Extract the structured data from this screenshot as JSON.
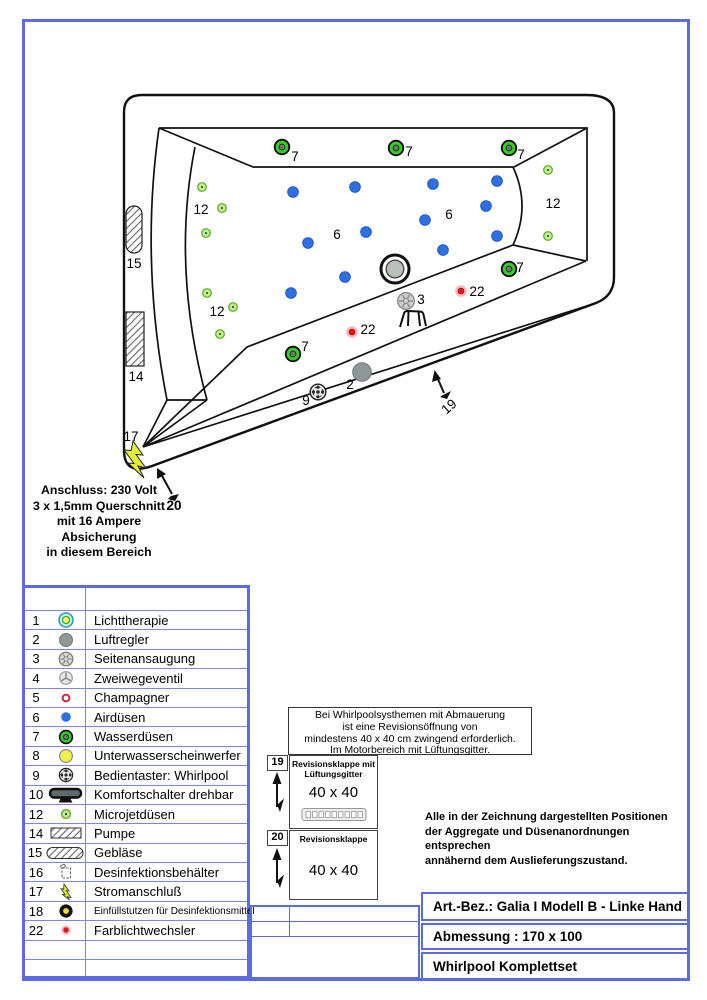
{
  "frame_color": "#5e6ae0",
  "diagram": {
    "colors": {
      "water": "#38cb2b",
      "air": "#2e6fe2",
      "micro": "#bdf08e",
      "micro_edge": "#55aa22",
      "color_light": "#e31515",
      "color_halo": "#f5b8c0"
    },
    "water_jets": [
      [
        282,
        147
      ],
      [
        396,
        148
      ],
      [
        509,
        148
      ],
      [
        509,
        269
      ],
      [
        293,
        354
      ]
    ],
    "air_jets": [
      [
        293,
        192
      ],
      [
        355,
        187
      ],
      [
        433,
        184
      ],
      [
        497,
        181
      ],
      [
        486,
        206
      ],
      [
        425,
        220
      ],
      [
        366,
        232
      ],
      [
        308,
        243
      ],
      [
        443,
        250
      ],
      [
        497,
        236
      ],
      [
        345,
        277
      ],
      [
        291,
        293
      ]
    ],
    "microjets": [
      [
        202,
        187
      ],
      [
        222,
        208
      ],
      [
        206,
        233
      ],
      [
        207,
        293
      ],
      [
        233,
        307
      ],
      [
        220,
        334
      ],
      [
        548,
        170
      ],
      [
        548,
        236
      ]
    ],
    "color_lights": [
      [
        461,
        291
      ],
      [
        352,
        332
      ]
    ],
    "drain": {
      "x": 395,
      "y": 269
    },
    "side_suction": {
      "x": 406,
      "y": 301
    },
    "air_regulator": {
      "x": 362,
      "y": 372
    },
    "control_button": {
      "x": 318,
      "y": 392
    },
    "labels": [
      {
        "t": "7",
        "x": 295,
        "y": 161
      },
      {
        "t": "7",
        "x": 409,
        "y": 156
      },
      {
        "t": "7",
        "x": 521,
        "y": 159
      },
      {
        "t": "7",
        "x": 520,
        "y": 272
      },
      {
        "t": "7",
        "x": 305,
        "y": 351
      },
      {
        "t": "12",
        "x": 201,
        "y": 214
      },
      {
        "t": "12",
        "x": 217,
        "y": 316
      },
      {
        "t": "12",
        "x": 553,
        "y": 208
      },
      {
        "t": "6",
        "x": 337,
        "y": 239
      },
      {
        "t": "6",
        "x": 449,
        "y": 219
      },
      {
        "t": "3",
        "x": 421,
        "y": 304
      },
      {
        "t": "22",
        "x": 477,
        "y": 296
      },
      {
        "t": "22",
        "x": 368,
        "y": 334
      },
      {
        "t": "2",
        "x": 350,
        "y": 389
      },
      {
        "t": "9",
        "x": 306,
        "y": 405
      },
      {
        "t": "14",
        "x": 136,
        "y": 381
      },
      {
        "t": "15",
        "x": 134,
        "y": 268
      },
      {
        "t": "17",
        "x": 131,
        "y": 441
      },
      {
        "t": "19",
        "x": 452,
        "y": 410,
        "rot": -42
      },
      {
        "t": "20",
        "x": 174,
        "y": 510,
        "b": true
      }
    ]
  },
  "connection_note": {
    "lines": [
      "Anschluss: 230 Volt",
      "3 x 1,5mm Querschnitt",
      "mit 16 Ampere",
      "Absicherung",
      "in diesem Bereich"
    ]
  },
  "legend": {
    "rows": [
      {
        "num": "1",
        "icon": "light-therapy",
        "label": "Lichttherapie"
      },
      {
        "num": "2",
        "icon": "air-regulator",
        "label": "Luftregler"
      },
      {
        "num": "3",
        "icon": "side-suction",
        "label": "Seitenansaugung"
      },
      {
        "num": "4",
        "icon": "two-way-valve",
        "label": "Zweiwegeventil"
      },
      {
        "num": "5",
        "icon": "champagne",
        "label": "Champagner"
      },
      {
        "num": "6",
        "icon": "air-jet",
        "label": "Airdüsen"
      },
      {
        "num": "7",
        "icon": "water-jet",
        "label": "Wasserdüsen"
      },
      {
        "num": "8",
        "icon": "underwater-light",
        "label": "Unterwasserscheinwerfer"
      },
      {
        "num": "9",
        "icon": "control-button",
        "label": "Bedientaster: Whirlpool"
      },
      {
        "num": "10",
        "icon": "comfort-switch",
        "label": "Komfortschalter drehbar"
      },
      {
        "num": "12",
        "icon": "microjet",
        "label": "Microjetdüsen"
      },
      {
        "num": "14",
        "icon": "pump",
        "label": "Pumpe"
      },
      {
        "num": "15",
        "icon": "blower",
        "label": "Gebläse"
      },
      {
        "num": "16",
        "icon": "disinfect-container",
        "label": "Desinfektionsbehälter"
      },
      {
        "num": "17",
        "icon": "power",
        "label": "Stromanschluß"
      },
      {
        "num": "18",
        "icon": "filler-neck",
        "label": "Einfüllstutzen für Desinfektionsmittel",
        "small": true
      },
      {
        "num": "22",
        "icon": "color-light",
        "label": "Farblichtwechsler"
      }
    ]
  },
  "wall_note": {
    "lines": [
      "Bei Whirlpoolsysthemen mit Abmauerung",
      "ist eine Revisionsöffnung von",
      "mindestens 40 x 40 cm zwingend erforderlich.",
      "Im Motorbereich mit Lüftungsgitter."
    ]
  },
  "revision19": {
    "number": "19",
    "title_line1": "Revisionsklappe mit",
    "title_line2": "Lüftungsgitter",
    "size": "40 x 40"
  },
  "revision20": {
    "number": "20",
    "title": "Revisionsklappe",
    "size": "40 x 40"
  },
  "positions_note": {
    "lines": [
      "Alle in der Zeichnung dargestellten Positionen",
      "der Aggregate und Düsenanordnungen entsprechen",
      "annähernd dem Auslieferungszustand."
    ]
  },
  "title_block": {
    "article": "Art.-Bez.: Galia I Modell B - Linke Hand",
    "dimensions": "Abmessung : 170 x 100",
    "set": "Whirlpool Komplettset"
  }
}
